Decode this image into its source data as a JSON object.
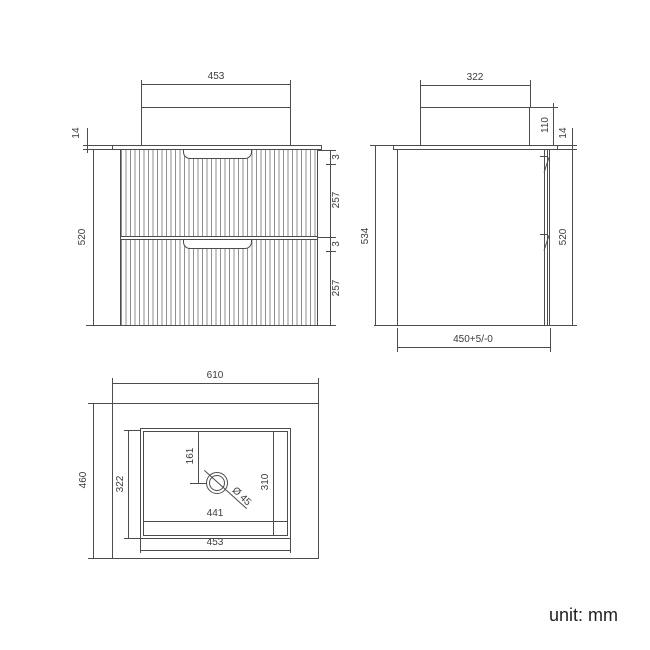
{
  "front": {
    "basin_width": "453",
    "counter_thickness": "14",
    "cabinet_height": "520",
    "gap_top": "3",
    "drawer_top_height": "257",
    "gap_mid": "3",
    "drawer_bottom_height": "257"
  },
  "side": {
    "basin_depth": "322",
    "basin_height": "110",
    "counter_thickness": "14",
    "total_height": "534",
    "cabinet_height": "520",
    "depth_tolerance": "450+5/-0"
  },
  "plan": {
    "width": "610",
    "depth": "460",
    "basin_depth": "322",
    "drain_offset": "161",
    "basin_inner_depth": "310",
    "basin_inner_width": "441",
    "basin_width": "453",
    "drain_diameter": "Ø 45"
  },
  "footer": {
    "unit": "unit: mm"
  },
  "colors": {
    "line": "#4c4c4c",
    "text": "#3b3b3b",
    "flute": "#8f8f8f",
    "background": "#ffffff"
  }
}
